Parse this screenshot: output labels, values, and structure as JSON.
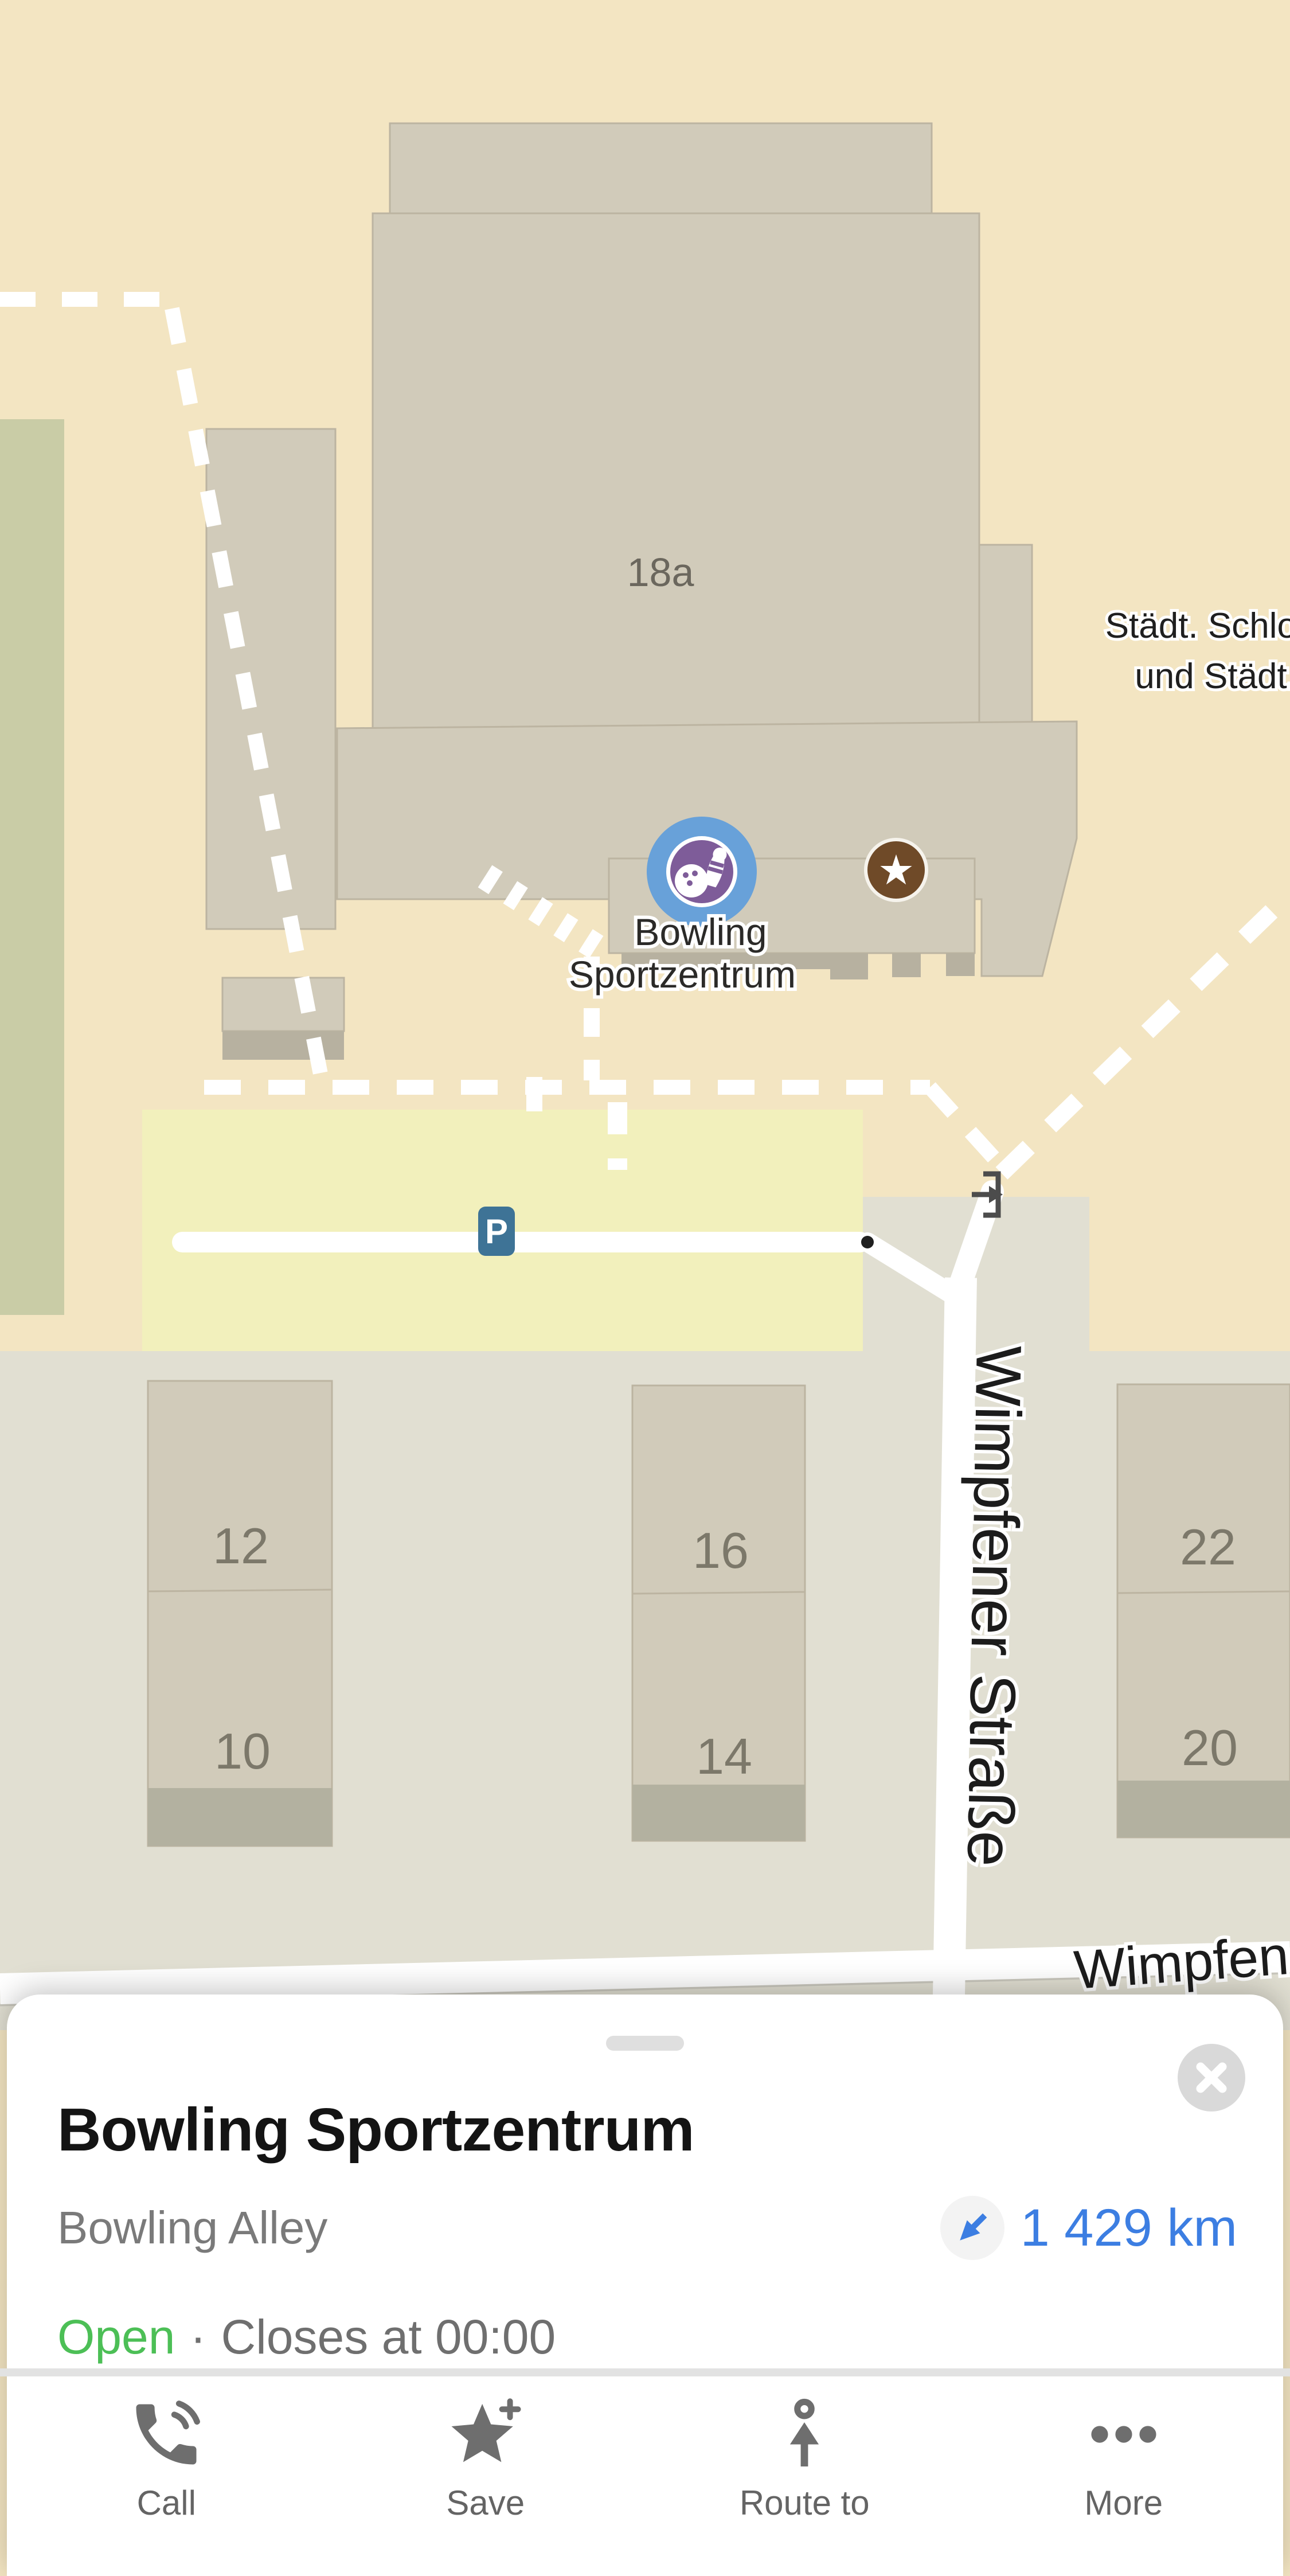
{
  "map": {
    "building_number_label": "18a",
    "area_label_line1": "Städt. Schlo",
    "area_label_line2": "und Städt.",
    "poi_label_line1": "Bowling",
    "poi_label_line2": "Sportzentrum",
    "street_label_vertical": "Wimpfener Straße",
    "street_label_bottom": "Wimpfener",
    "parking_glyph": "P",
    "star_glyph": "★",
    "house_numbers": [
      "12",
      "10",
      "16",
      "14",
      "22",
      "20"
    ],
    "icons": {
      "bowling_marker": "bowling-pin-and-ball",
      "favorite_marker": "star",
      "parking_marker": "letter-P",
      "entrance_marker": "arrow-into-bracket"
    },
    "colors": {
      "background_tan": "#f3e5c2",
      "building_gray": "#d1cbba",
      "building_shadow": "#b7b1a0",
      "lower_area_gray": "#e1dfd2",
      "parking_yellow": "#f2f0bc",
      "green_area": "#c9cca6",
      "road_white": "#ffffff",
      "marker_blue": "#68a1d9",
      "marker_purple": "#7e5c99",
      "star_brown": "#6f4a28",
      "parking_blue": "#3e7396"
    }
  },
  "sheet": {
    "title": "Bowling Sportzentrum",
    "category": "Bowling Alley",
    "distance": "1 429 km",
    "status": {
      "open": "Open",
      "separator": "·",
      "closes": "Closes at 00:00"
    },
    "actions": [
      {
        "label": "Call",
        "icon": "phone-icon"
      },
      {
        "label": "Save",
        "icon": "star-plus-icon"
      },
      {
        "label": "Route to",
        "icon": "route-arrow-icon"
      },
      {
        "label": "More",
        "icon": "ellipsis-icon"
      }
    ],
    "colors": {
      "open_green": "#4cbf56",
      "distance_blue": "#3c7ee2",
      "title_black": "#141414",
      "icon_gray": "#6e6e6e"
    }
  }
}
